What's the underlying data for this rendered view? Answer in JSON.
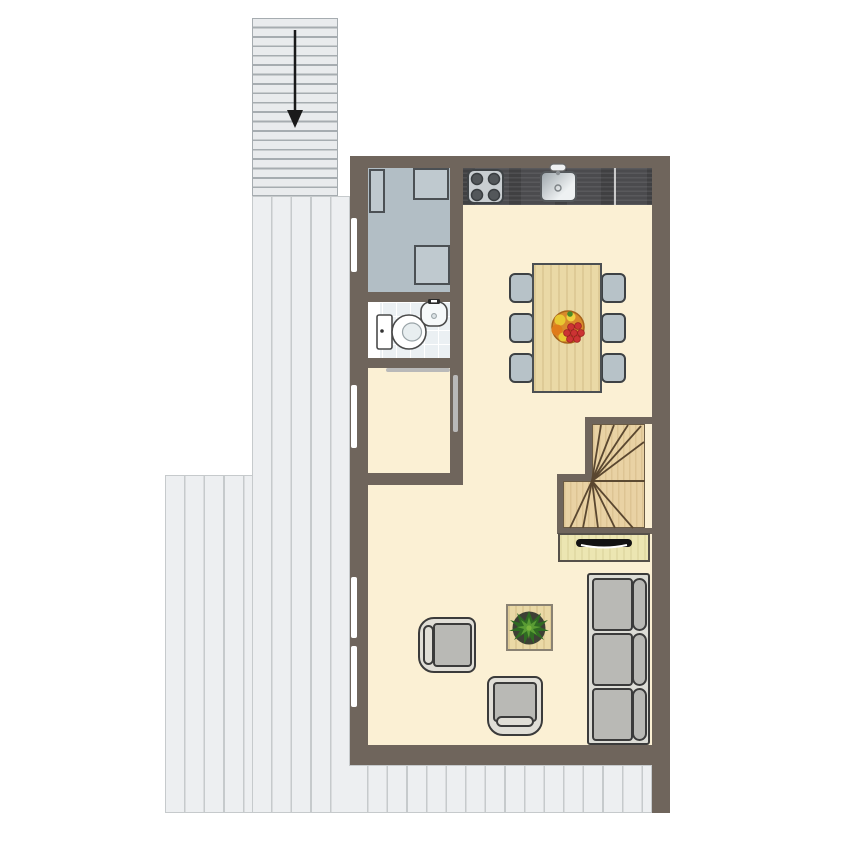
{
  "meta": {
    "type": "floor-plan",
    "description": "Apartment floor plan: open kitchen-dining-living space with storage room, bathroom, hallway, winder staircase, exterior entrance stairs and wrap-around wooden terrace",
    "no_visible_text": true
  },
  "palette": {
    "wall": "#6f655c",
    "floor_cream": "#fbf0d4",
    "deck_fill": "#edeff1",
    "deck_line": "#c6cacc",
    "stair_ext_fill": "#e9ebed",
    "stair_ext_line": "#a6acb0",
    "gray_room": "#b2bec5",
    "appliance": "#bfc9cf",
    "appliance_border": "#4b5054",
    "counter_dark": "#4b4b4e",
    "cooktop": "#c9ced1",
    "burner": "#53575a",
    "tile": "#ebf0f3",
    "fixture_white": "#ffffff",
    "table_wood": "#ead9a6",
    "chair_fill": "#b7c2c8",
    "stair_wood": "#e9d2a4",
    "stair_line": "#5a4730",
    "sideboard": "#ece6b2",
    "sofa_frame": "#dcdcd6",
    "cushion": "#b9b9b5",
    "armchair_frame": "#e0ded7",
    "window_white": "#ffffff",
    "door_gray": "#b9b9b9",
    "plant_green_dark": "#2f6b22",
    "plant_green_light": "#6fae38",
    "fruit_orange": "#e07b1a",
    "fruit_red": "#cc3333",
    "fruit_yellow": "#e8c832",
    "arrow_black": "#1a1a1a"
  },
  "rooms": [
    {
      "name": "exterior-staircase",
      "feature": "down-arrow"
    },
    {
      "name": "terrace-deck",
      "sections": 3
    },
    {
      "name": "storage-room",
      "appliances": 3
    },
    {
      "name": "bathroom",
      "fixtures": [
        "toilet",
        "washbasin"
      ]
    },
    {
      "name": "hallway"
    },
    {
      "name": "kitchen",
      "counter_items": [
        "cooktop",
        "sink"
      ]
    },
    {
      "name": "dining-area",
      "chairs": 6
    },
    {
      "name": "living-area"
    },
    {
      "name": "interior-winder-staircase",
      "treads_upper": 5,
      "treads_lower": 6
    }
  ],
  "furniture": {
    "dining_table": {
      "seats": 6,
      "centerpiece": "fruit-bowl"
    },
    "cooktop_burners": 4,
    "sofa_seats": 3,
    "armchairs": 2,
    "coffee_table_plant": 1,
    "sideboard_drawers": 1,
    "left_wall_windows": 4
  }
}
